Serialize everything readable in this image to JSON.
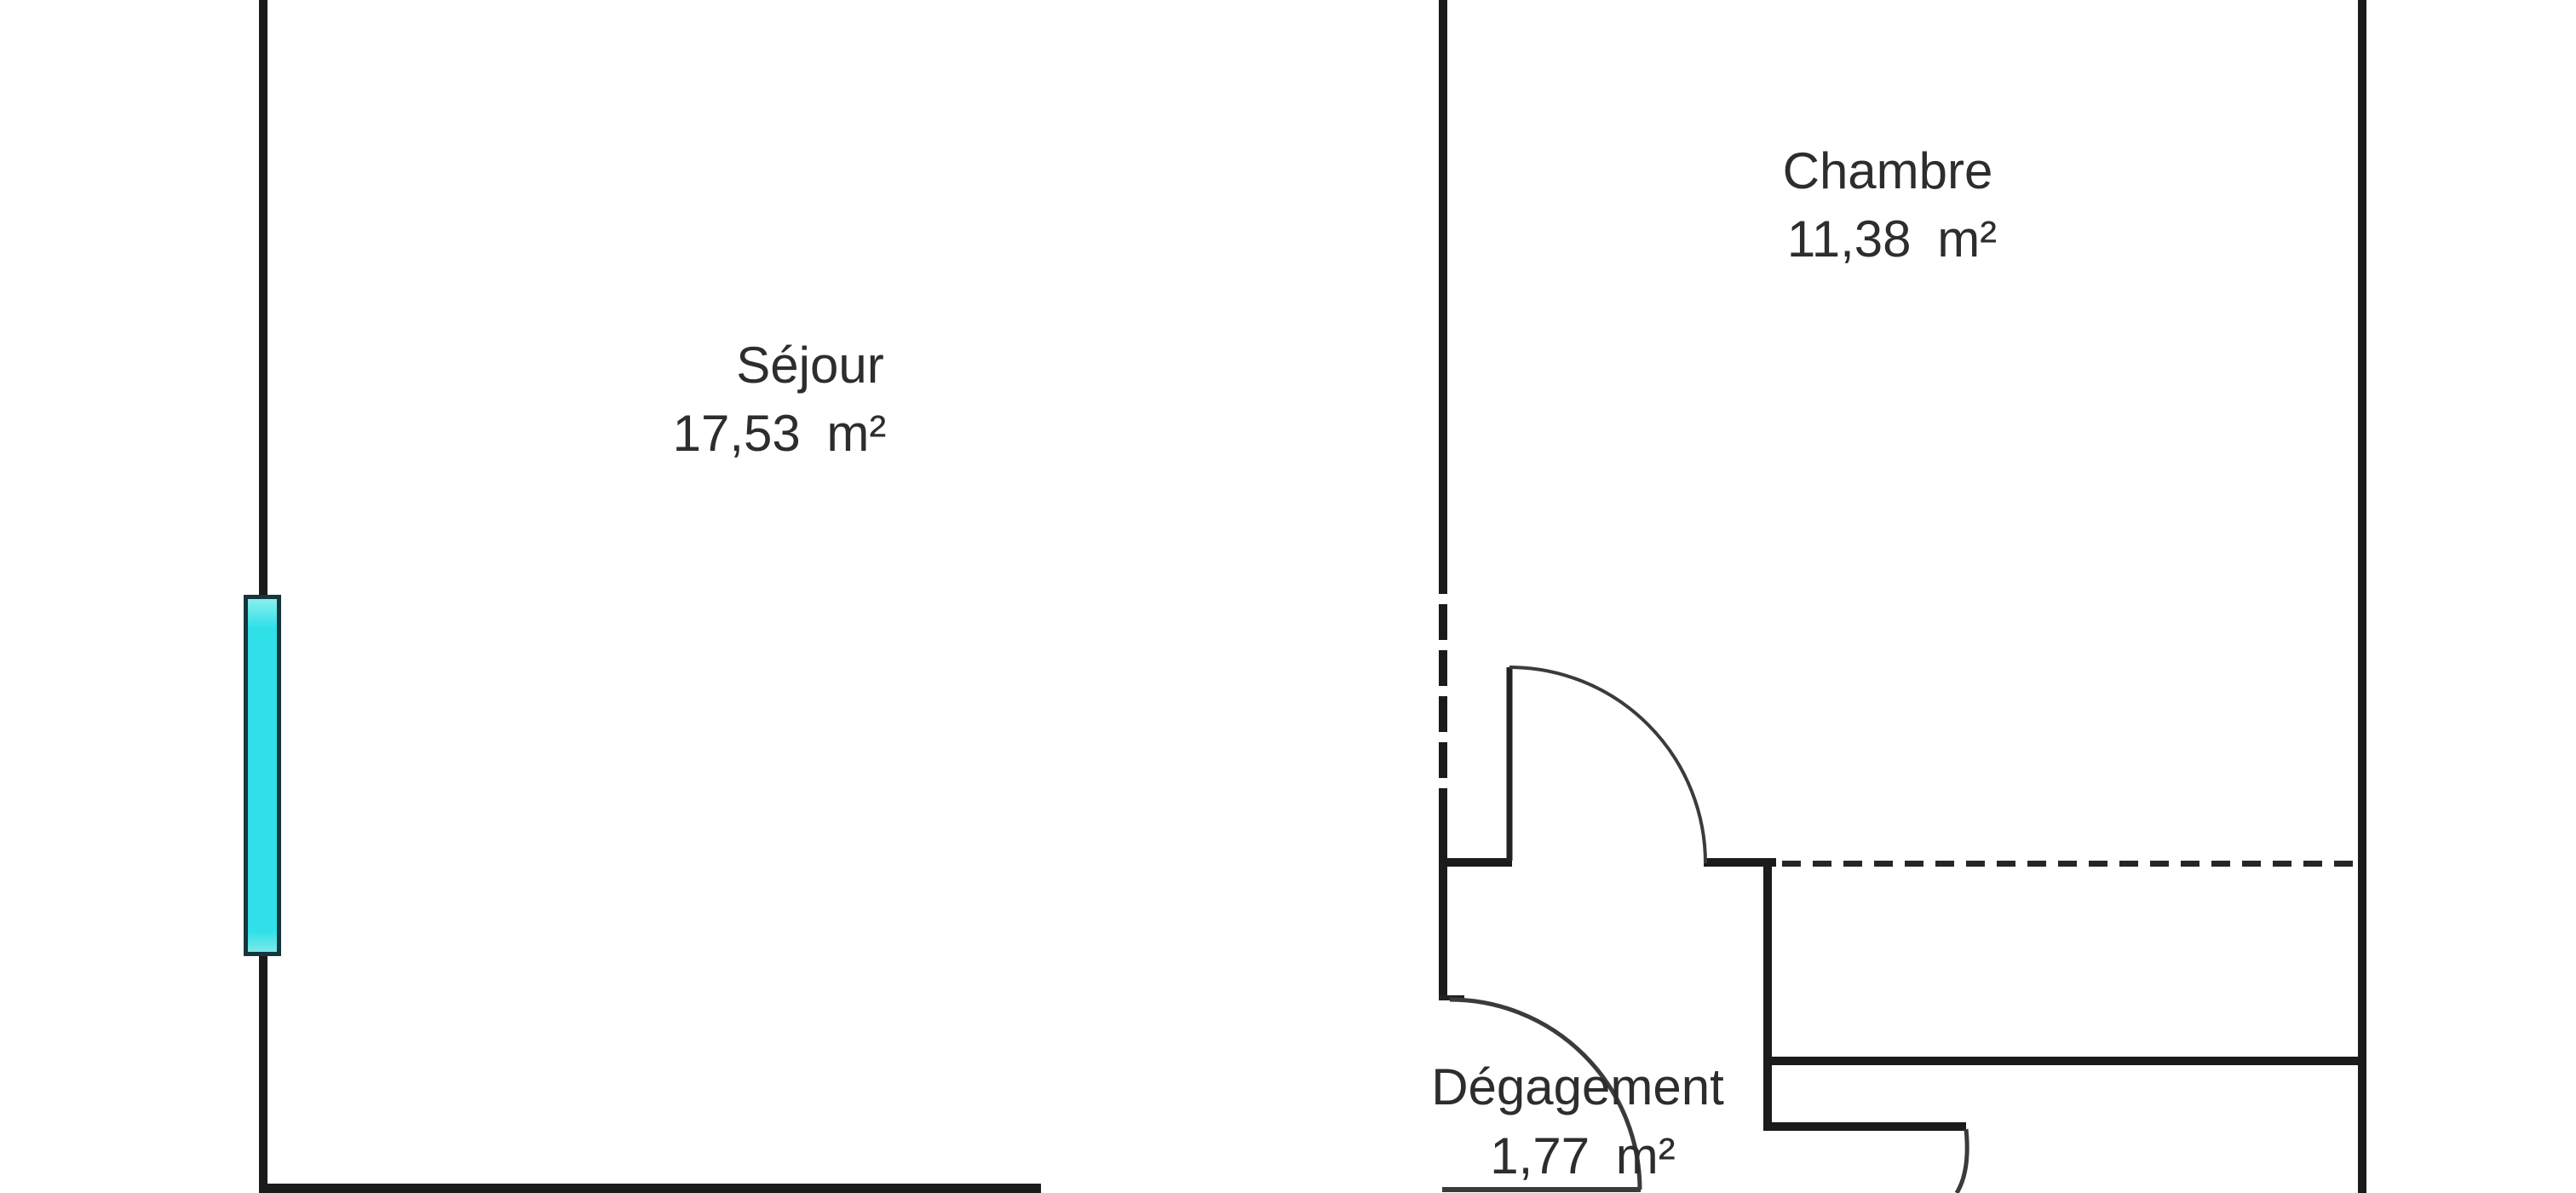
{
  "plan_title": "floor-plan",
  "rooms": {
    "sejour": {
      "name": "Séjour",
      "area": "17,53 m²"
    },
    "chambre": {
      "name": "Chambre",
      "area": "11,38 m²"
    },
    "degagement": {
      "name": "Dégagement",
      "area": "1,77 m²"
    }
  },
  "colors": {
    "background": "#ffffff",
    "wall": "#1b1b1b",
    "text": "#2d2d2d",
    "window_fill": "#2fe0e9",
    "window_border": "#16363c"
  }
}
